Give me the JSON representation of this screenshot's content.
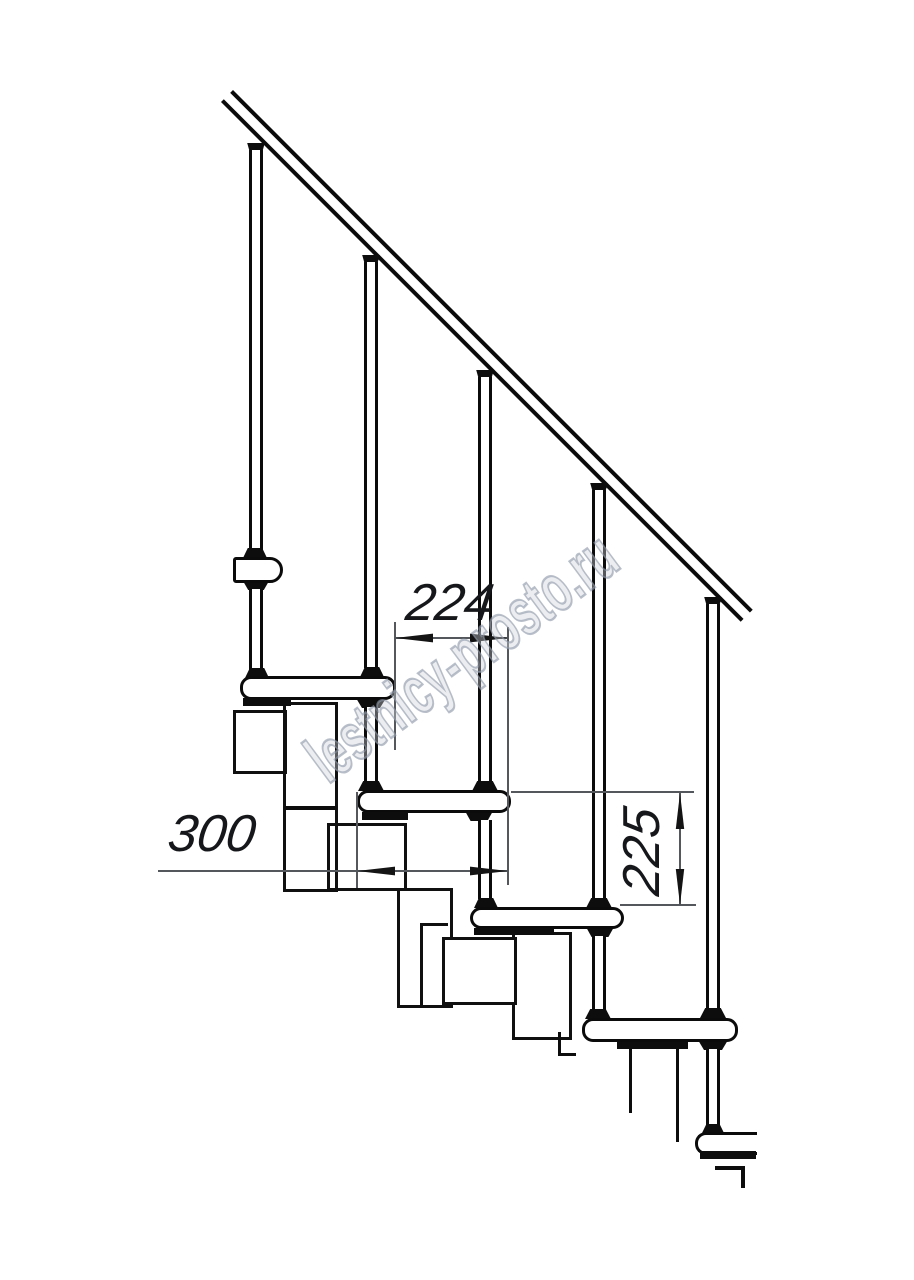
{
  "drawing": {
    "kind": "modular-staircase-side-elevation",
    "watermark": "lestnicy-prosto.ru",
    "dimensions": {
      "step_run": "224",
      "tread_depth": "300",
      "riser_height": "225"
    },
    "colors": {
      "line": "#0b0b0b",
      "dim_line": "#54585d",
      "watermark": "#8f9aaa",
      "background": "#ffffff"
    }
  }
}
